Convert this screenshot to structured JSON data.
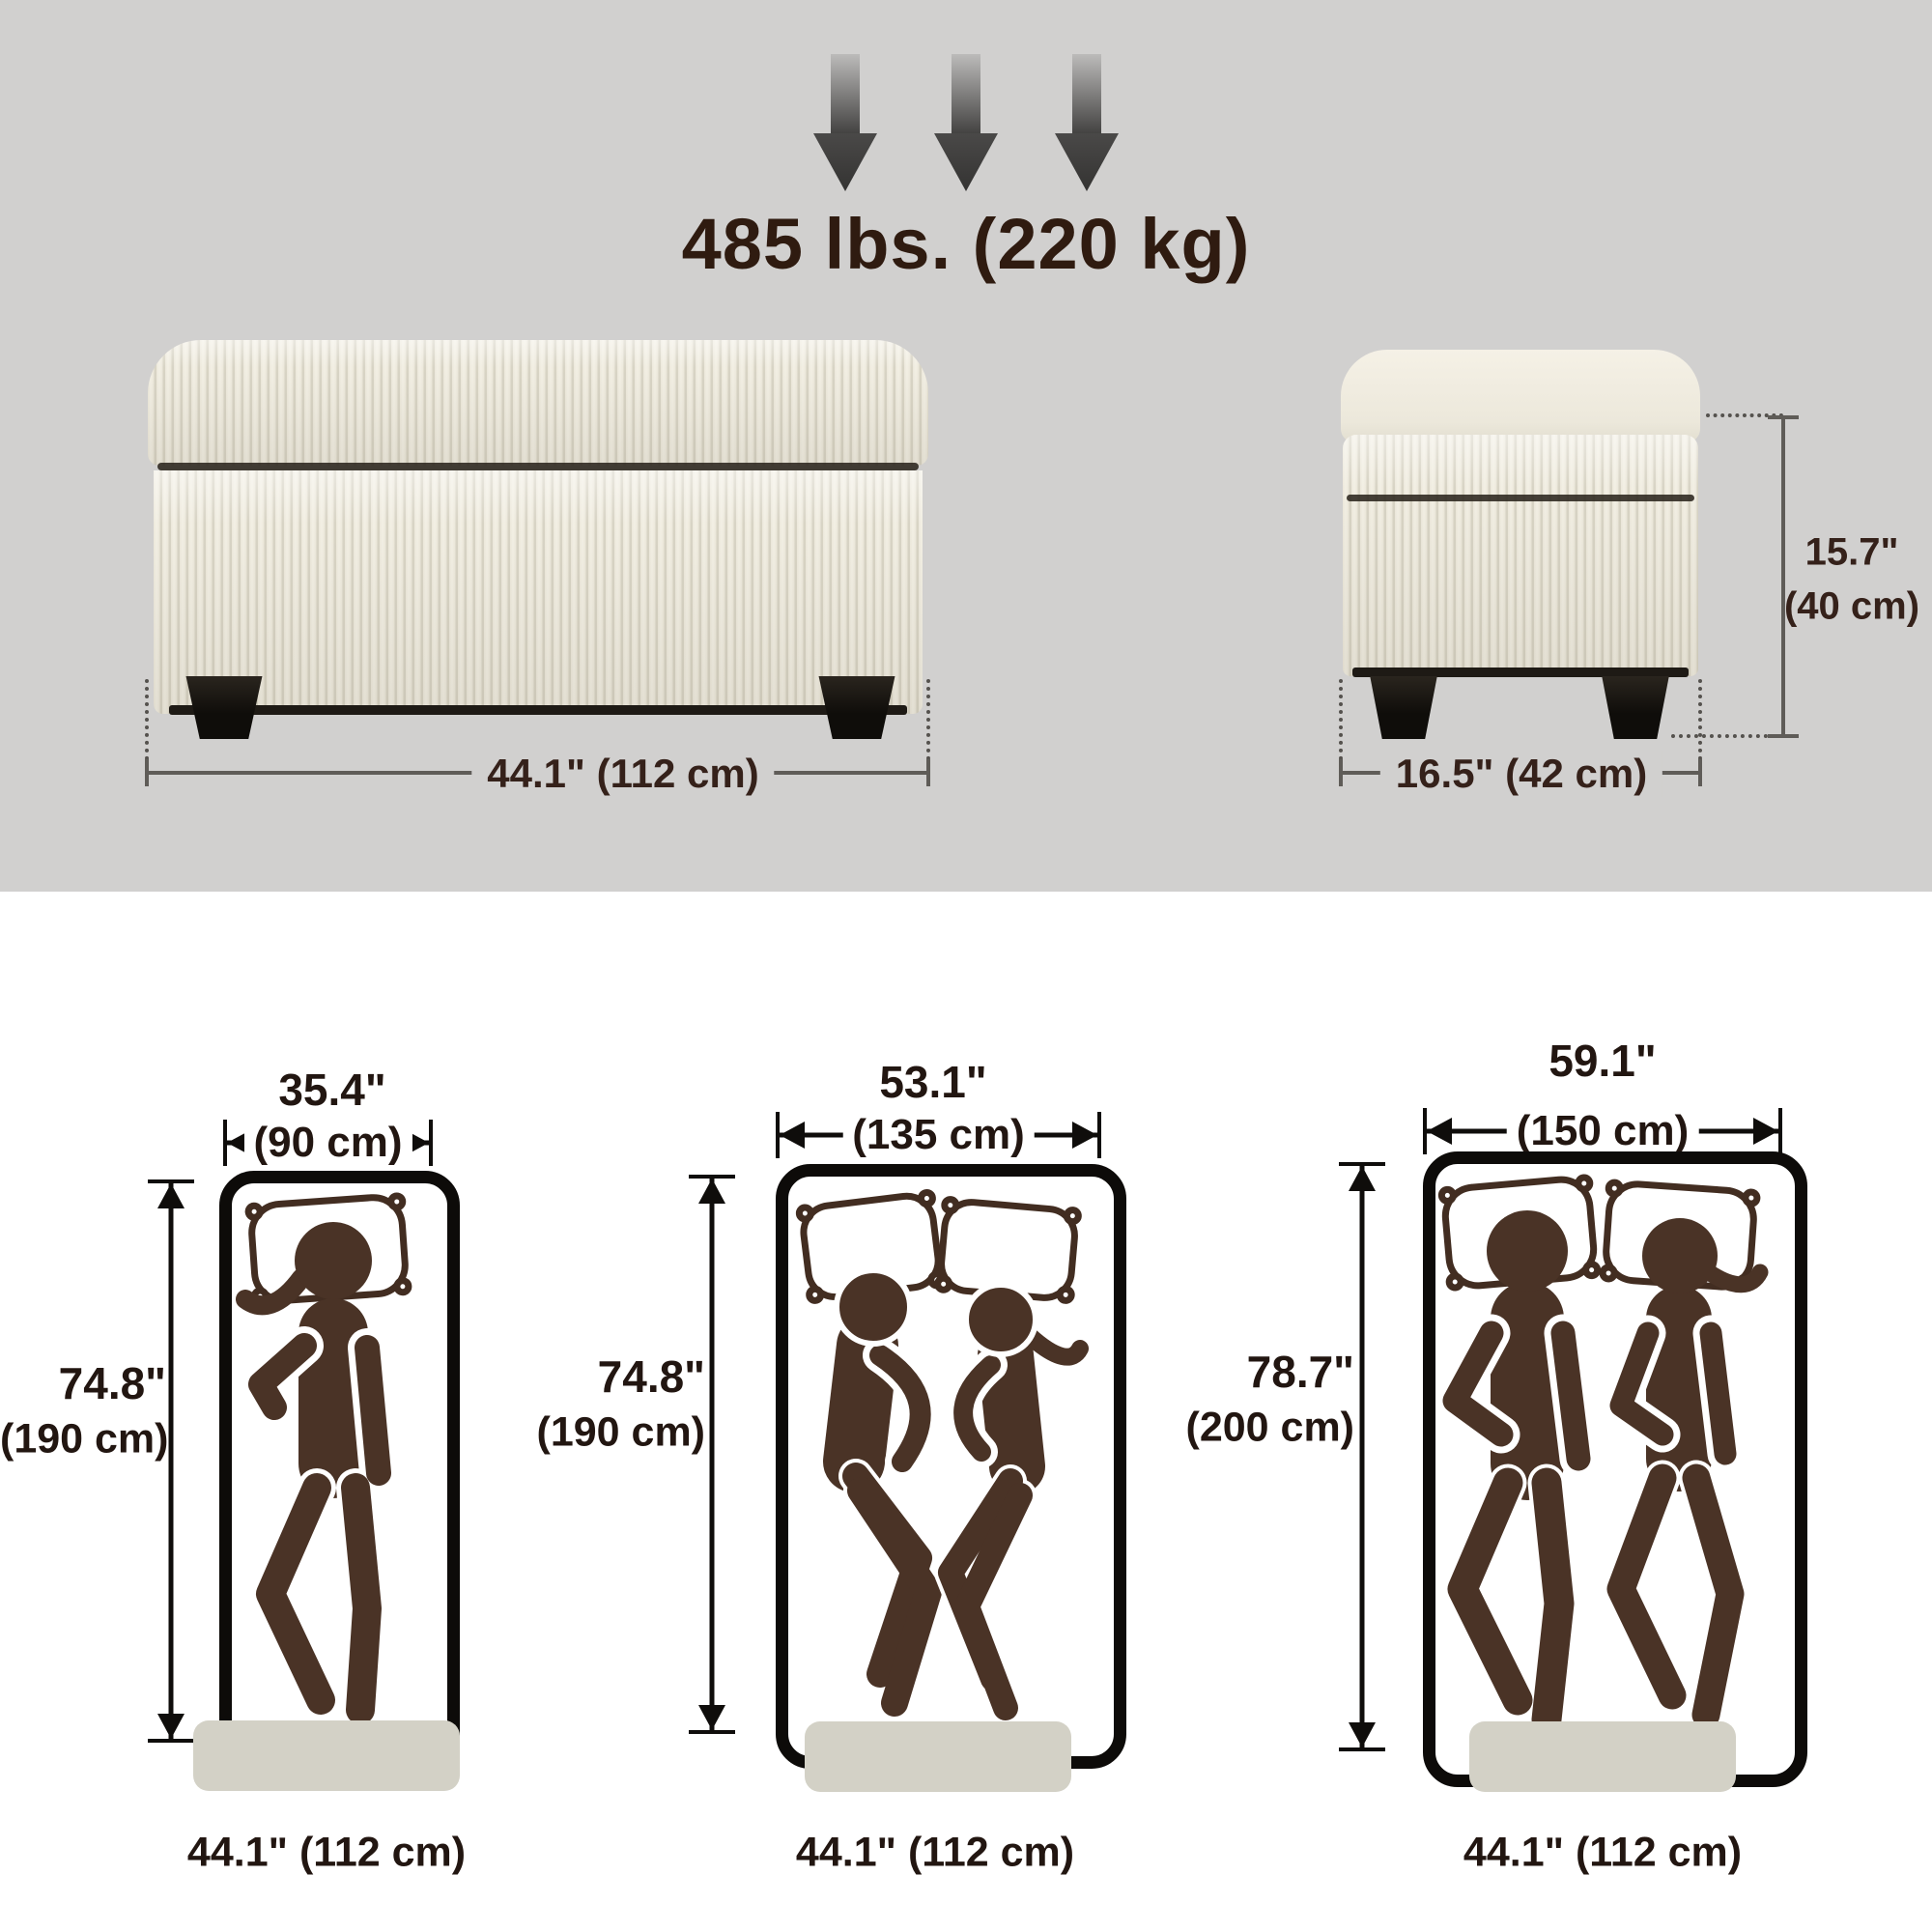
{
  "capacity_label": "485 lbs. (220 kg)",
  "front_bench": {
    "width_label": "44.1\" (112 cm)"
  },
  "side_bench": {
    "depth_label": "16.5\" (42 cm)",
    "height_in": "15.7\"",
    "height_cm": "(40 cm)"
  },
  "beds": [
    {
      "name": "single-mattress",
      "sleepers": 1,
      "width_in": "35.4\"",
      "width_cm": "(90 cm)",
      "length_in": "74.8\"",
      "length_cm": "(190 cm)",
      "bench_label": "44.1\" (112 cm)"
    },
    {
      "name": "double-mattress",
      "sleepers": 2,
      "width_in": "53.1\"",
      "width_cm": "(135 cm)",
      "length_in": "74.8\"",
      "length_cm": "(190 cm)",
      "bench_label": "44.1\" (112 cm)"
    },
    {
      "name": "queen-mattress",
      "sleepers": 2,
      "width_in": "59.1\"",
      "width_cm": "(150 cm)",
      "length_in": "78.7\"",
      "length_cm": "(200 cm)",
      "bench_label": "44.1\" (112 cm)"
    }
  ],
  "colors": {
    "background_top": "#d1d0cf",
    "background_bottom": "#ffffff",
    "text_brown": "#2f1b10",
    "figure_brown": "#4a3326",
    "fabric_cream": "#ece8db",
    "leg_black": "#17130e",
    "bench_swatch": "#d3d1c6"
  }
}
